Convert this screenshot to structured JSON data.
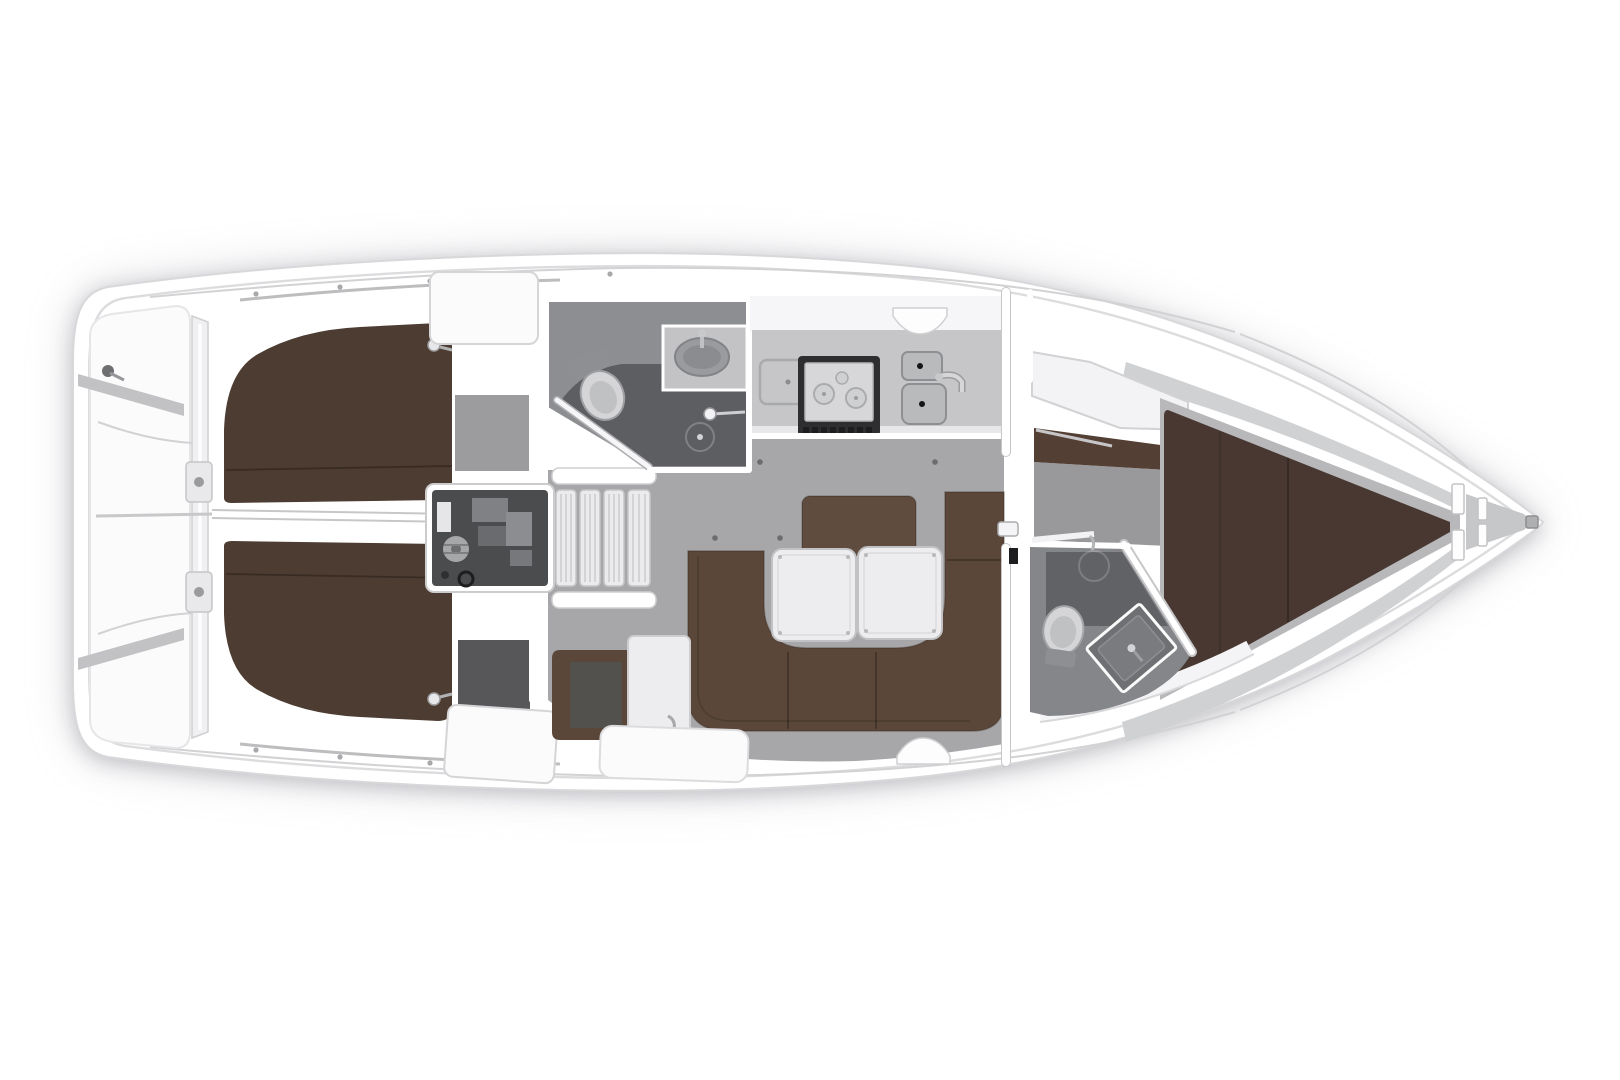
{
  "title": "Sailing yacht interior layout floor plan, top view",
  "canvas": {
    "width": 1620,
    "height": 1080,
    "background": "#ffffff"
  },
  "colors": {
    "hull_white": "#ffffff",
    "hull_edge": "#d8d8da",
    "inner_edge": "#dcdcde",
    "panel_white": "#fbfbfc",
    "panel_edge": "#e6e6e8",
    "deck_trim": "#c2c2c4",
    "bulkhead_gray": "#f0f0f2",
    "hardware_gray": "#e9e9eb",
    "fitting_dark": "#6e6f71",
    "berth_brown": "#4d3c31",
    "berth_brown_fwd": "#483831",
    "cabinet_brown": "#533f33",
    "sofa_brown": "#5a473a",
    "backrest_brown": "#5f4c3e",
    "navseat_brown": "#5a473a",
    "navseat_inner": "#53514e",
    "floor_gray": "#a7a7a9",
    "cabin_floor_port": "#9c9c9e",
    "cabin_floor_stbd": "#57575a",
    "corridor_gray": "#99999b",
    "platform_gray": "#b8b8ba",
    "taper_band": "#d0d1d3",
    "head_floor": "#8d8e91",
    "head_floor_fwd": "#85868a",
    "shower_dark": "#5d5e61",
    "vanity_gray": "#c3c3c5",
    "sink_gray": "#9a9b9e",
    "sink_inner": "#8b8c8f",
    "toilet_white": "#d5d5d7",
    "toilet_seat": "#c0c1c3",
    "tank_gray": "#8e8f92",
    "counter_gray": "#c6c6c8",
    "counter_face": "#e8e8ea",
    "cabinet_white": "#f6f6f8",
    "stove_frame": "#2e2e30",
    "stove_top": "#d7d7d9",
    "burner_gray": "#cfd0d2",
    "vent_dark": "#1d1d1f",
    "basin_gray": "#b9babc",
    "drain_dark": "#141416",
    "faucet_gray": "#d6d6d8",
    "engine_bay": "#4b4c4e",
    "engine_light": "#e6e6e8",
    "engine_mid": "#8c8d90",
    "engine_part1": "#808184",
    "engine_part2": "#6a6b6e",
    "engine_pulley": "#a6a7a9",
    "step_white": "#ebebed",
    "table_white": "#ededef",
    "table_edge": "#c2c2c4",
    "shelf_white": "#f3f3f5",
    "vanity_fwd": "#6f7073",
    "vanity_fwd_inner": "#7a7b7e",
    "locker_gray": "#c6c7c9",
    "dot_dark": "#6b6c6e"
  },
  "regions": [
    {
      "id": "stern-platform"
    },
    {
      "id": "transom-bulkhead"
    },
    {
      "id": "aft-cabin-port"
    },
    {
      "id": "aft-cabin-starboard"
    },
    {
      "id": "engine-compartment"
    },
    {
      "id": "companionway-stairs"
    },
    {
      "id": "aft-head"
    },
    {
      "id": "galley"
    },
    {
      "id": "salon"
    },
    {
      "id": "nav-seat"
    },
    {
      "id": "forward-head"
    },
    {
      "id": "forward-cabin"
    },
    {
      "id": "anchor-locker"
    }
  ]
}
